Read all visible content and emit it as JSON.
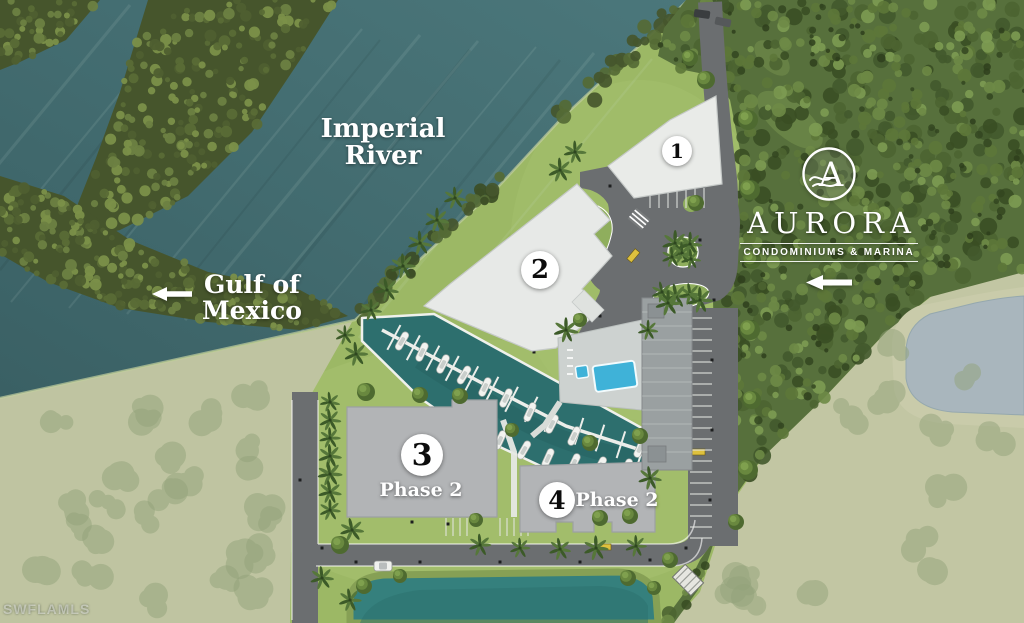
{
  "map": {
    "labels": {
      "river": {
        "line1": "Imperial",
        "line2": "River"
      },
      "gulf": {
        "line1": "Gulf of",
        "line2": "Mexico"
      }
    },
    "logo": {
      "monogram": "A",
      "name": "AURORA",
      "tagline": "CONDOMINIUMS & MARINA"
    },
    "buildings": [
      {
        "number": "1",
        "phase": ""
      },
      {
        "number": "2",
        "phase": ""
      },
      {
        "number": "3",
        "phase": "Phase 2"
      },
      {
        "number": "4",
        "phase": "Phase 2"
      }
    ],
    "watermark": "SWFLAMLS",
    "colors": {
      "river": "#41686b",
      "marina": "#2d6f6e",
      "forest": "#57703c",
      "grass": "#9cb865",
      "field": "#bfc4a1",
      "road": "#6b6e70",
      "building_light": "#e8eae7",
      "building_gray": "#b2b4b6",
      "pool": "#3fb2d8",
      "pond": "#a9b6bd"
    }
  }
}
